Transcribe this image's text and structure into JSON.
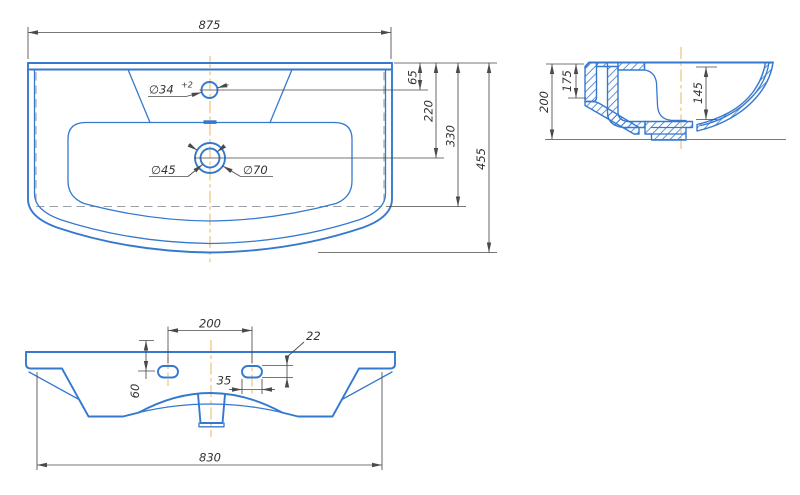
{
  "document": {
    "type": "technical-drawing",
    "subject": "washbasin three-view dimensional drawing"
  },
  "colors": {
    "blue": "#3579cf",
    "gray": "#4a4a4a",
    "orange": "#eeba6a",
    "hidden": "#9aa0a8",
    "bg": "#ffffff"
  },
  "views": {
    "top": {
      "name": "top view",
      "dims": {
        "width": "875",
        "faucet_offset": "65",
        "drain_offset": "220",
        "cabinet_depth": "330",
        "total_depth": "455",
        "faucet_hole": "∅34",
        "faucet_tol": "+2",
        "drain_inner": "∅45",
        "drain_outer": "∅70"
      }
    },
    "side": {
      "name": "side section view",
      "dims": {
        "height": "200",
        "back_height": "175",
        "bowl_depth": "145"
      }
    },
    "front": {
      "name": "front view",
      "dims": {
        "slot_spacing": "200",
        "slot_height": "22",
        "slot_length": "35",
        "slot_drop": "60",
        "body_width": "830"
      }
    }
  }
}
